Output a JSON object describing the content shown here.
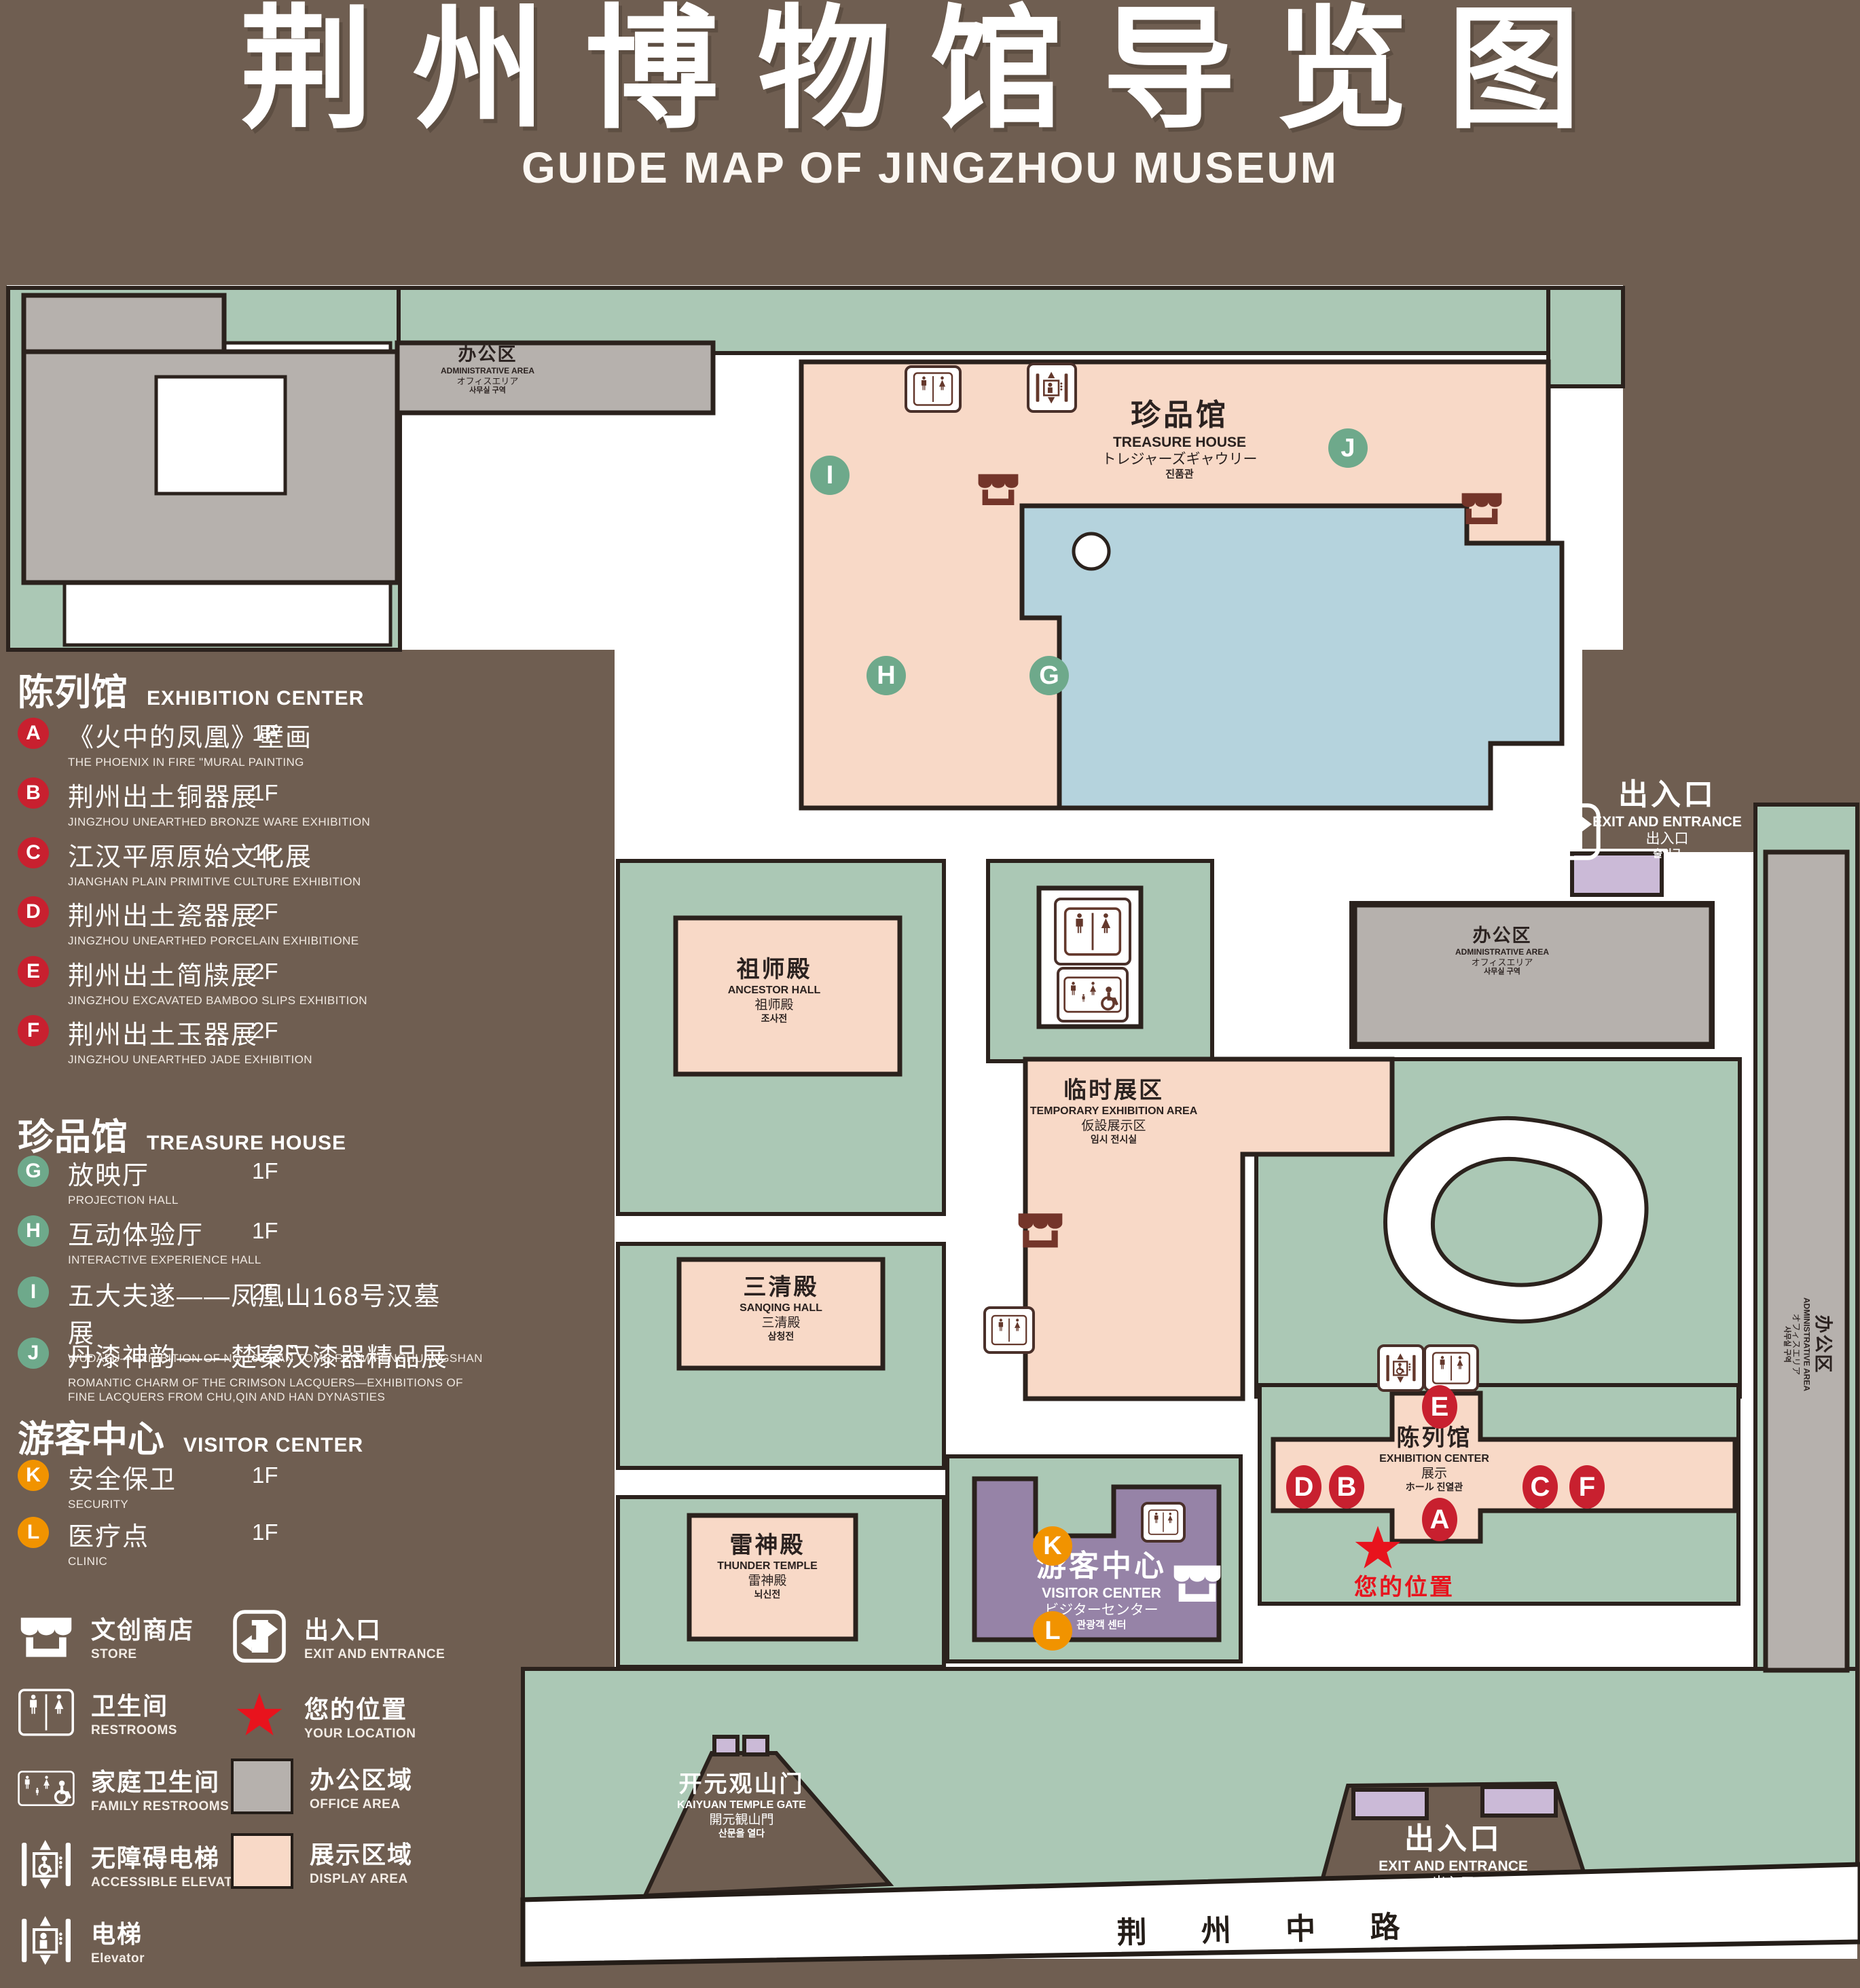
{
  "title": {
    "zh": "荆州博物馆导览图",
    "en": "GUIDE MAP OF JINGZHOU MUSEUM"
  },
  "legend": {
    "sections": [
      {
        "zh": "陈列馆",
        "en": "EXHIBITION CENTER",
        "items": [
          {
            "id": "A",
            "zh": "《火中的凤凰》壁画",
            "en": "THE PHOENIX IN FIRE \"MURAL PAINTING",
            "floor": "1F"
          },
          {
            "id": "B",
            "zh": "荆州出土铜器展",
            "en": "JINGZHOU UNEARTHED BRONZE WARE EXHIBITION",
            "floor": "1F"
          },
          {
            "id": "C",
            "zh": "江汉平原原始文化展",
            "en": "JIANGHAN PLAIN PRIMITIVE CULTURE EXHIBITION",
            "floor": "1F"
          },
          {
            "id": "D",
            "zh": "荆州出土瓷器展",
            "en": "JINGZHOU UNEARTHED PORCELAIN EXHIBITIONE",
            "floor": "2F"
          },
          {
            "id": "E",
            "zh": "荆州出土简牍展",
            "en": "JINGZHOU EXCAVATED BAMBOO SLIPS EXHIBITION",
            "floor": "2F"
          },
          {
            "id": "F",
            "zh": "荆州出土玉器展",
            "en": "JINGZHOU UNEARTHED JADE EXHIBITION",
            "floor": "2F"
          }
        ]
      },
      {
        "zh": "珍品馆",
        "en": "TREASURE HOUSE",
        "items": [
          {
            "id": "G",
            "zh": "放映厅",
            "en": "PROJECTION HALL",
            "floor": "1F"
          },
          {
            "id": "H",
            "zh": "互动体验厅",
            "en": "INTERACTIVE EXPERIENCE HALL",
            "floor": "1F"
          },
          {
            "id": "I",
            "zh": "五大夫遂——凤凰山168号汉墓展",
            "en": "WUDAFU—EXHIBITION OF NO.168 HAN TOMB FROM FENGHUANGSHAN",
            "floor": "2F"
          },
          {
            "id": "J",
            "zh": "丹漆神韵——楚秦汉漆器精品展",
            "en": "ROMANTIC CHARM OF THE CRIMSON LACQUERS—EXHIBITIONS OF FINE LACQUERS FROM CHU,QIN AND HAN DYNASTIES",
            "floor": "1-2F"
          }
        ]
      },
      {
        "zh": "游客中心",
        "en": "VISITOR CENTER",
        "items": [
          {
            "id": "K",
            "zh": "安全保卫",
            "en": "SECURITY",
            "floor": "1F"
          },
          {
            "id": "L",
            "zh": "医疗点",
            "en": "CLINIC",
            "floor": "1F"
          }
        ]
      }
    ],
    "symbols": {
      "store": {
        "zh": "文创商店",
        "en": "STORE"
      },
      "exit": {
        "zh": "出入口",
        "en": "EXIT AND ENTRANCE"
      },
      "restrooms": {
        "zh": "卫生间",
        "en": "RESTROOMS"
      },
      "location": {
        "zh": "您的位置",
        "en": "YOUR LOCATION"
      },
      "family_restrooms": {
        "zh": "家庭卫生间",
        "en": "FAMILY RESTROOMS"
      },
      "office_area": {
        "zh": "办公区域",
        "en": "OFFICE AREA"
      },
      "accessible_elevator": {
        "zh": "无障碍电梯",
        "en": "ACCESSIBLE ELEVATOR"
      },
      "display_area": {
        "zh": "展示区域",
        "en": "DISPLAY AREA"
      },
      "elevator": {
        "zh": "电梯",
        "en": "Elevator"
      }
    }
  },
  "map": {
    "labels": {
      "treasure_house": {
        "zh": "珍品馆",
        "en": "TREASURE HOUSE",
        "ja": "トレジャーズギャウリー",
        "ko": "진품관"
      },
      "admin_area_nw": {
        "zh": "办公区",
        "en": "ADMINISTRATIVE AREA",
        "ja": "オフィスエリア",
        "ko": "사무실 구역"
      },
      "admin_area_e": {
        "zh": "办公区",
        "en": "ADMINISTRATIVE AREA",
        "ja": "オフィスエリア",
        "ko": "사무실 구역"
      },
      "admin_area_strip": {
        "zh": "办公区",
        "en": "ADMINISTRATIVE AREA",
        "ja": "オフィスエリア",
        "ko": "사무실 구역"
      },
      "ancestor_hall": {
        "zh": "祖师殿",
        "en": "ANCESTOR HALL",
        "ja": "祖师殿",
        "ko": "조사전"
      },
      "temporary_area": {
        "zh": "临时展区",
        "en": "TEMPORARY EXHIBITION AREA",
        "ja": "仮設展示区",
        "ko": "임시 전시실"
      },
      "sanqing_hall": {
        "zh": "三清殿",
        "en": "SANQING HALL",
        "ja": "三清殿",
        "ko": "삼청전"
      },
      "thunder_temple": {
        "zh": "雷神殿",
        "en": "THUNDER TEMPLE",
        "ja": "雷神殿",
        "ko": "뇌신전"
      },
      "visitor_center": {
        "zh": "游客中心",
        "en": "VISITOR CENTER",
        "ja": "ビジターセンター",
        "ko": "관광객 센터"
      },
      "exhibition_center": {
        "zh": "陈列馆",
        "en": "EXHIBITION CENTER",
        "ja": "展示",
        "ko": "ホール 진열관"
      },
      "exit_east": {
        "zh": "出入口",
        "en": "EXIT AND ENTRANCE",
        "ja": "出入口",
        "ko": "출입구"
      },
      "exit_south": {
        "zh": "出入口",
        "en": "EXIT AND ENTRANCE",
        "ja": "出入口",
        "ko": "출입구"
      },
      "kaiyuan_gate": {
        "zh": "开元观山门",
        "en": "KAIYUAN TEMPLE GATE",
        "ja": "開元観山門",
        "ko": "산문을 열다"
      },
      "road": {
        "zh": "荆 州 中 路"
      },
      "your_location": {
        "zh": "您的位置"
      }
    },
    "markers": {
      "A": "A",
      "B": "B",
      "C": "C",
      "D": "D",
      "E": "E",
      "F": "F",
      "G": "G",
      "H": "H",
      "I": "I",
      "J": "J",
      "K": "K",
      "L": "L"
    }
  },
  "colors": {
    "background": "#6f5e51",
    "lawn": "#abc8b5",
    "display_area": "#f8d9c7",
    "office_area": "#b6b1ad",
    "visitor_center": "#9683a7",
    "pond": "#b5d3dd",
    "gate_block": "#cbbad7",
    "marker_red": "#c8202f",
    "marker_green": "#6ea98b",
    "marker_orange": "#f19300",
    "location_red": "#e8131d",
    "icon_dark": "#64382c",
    "outline": "#2b221d"
  }
}
